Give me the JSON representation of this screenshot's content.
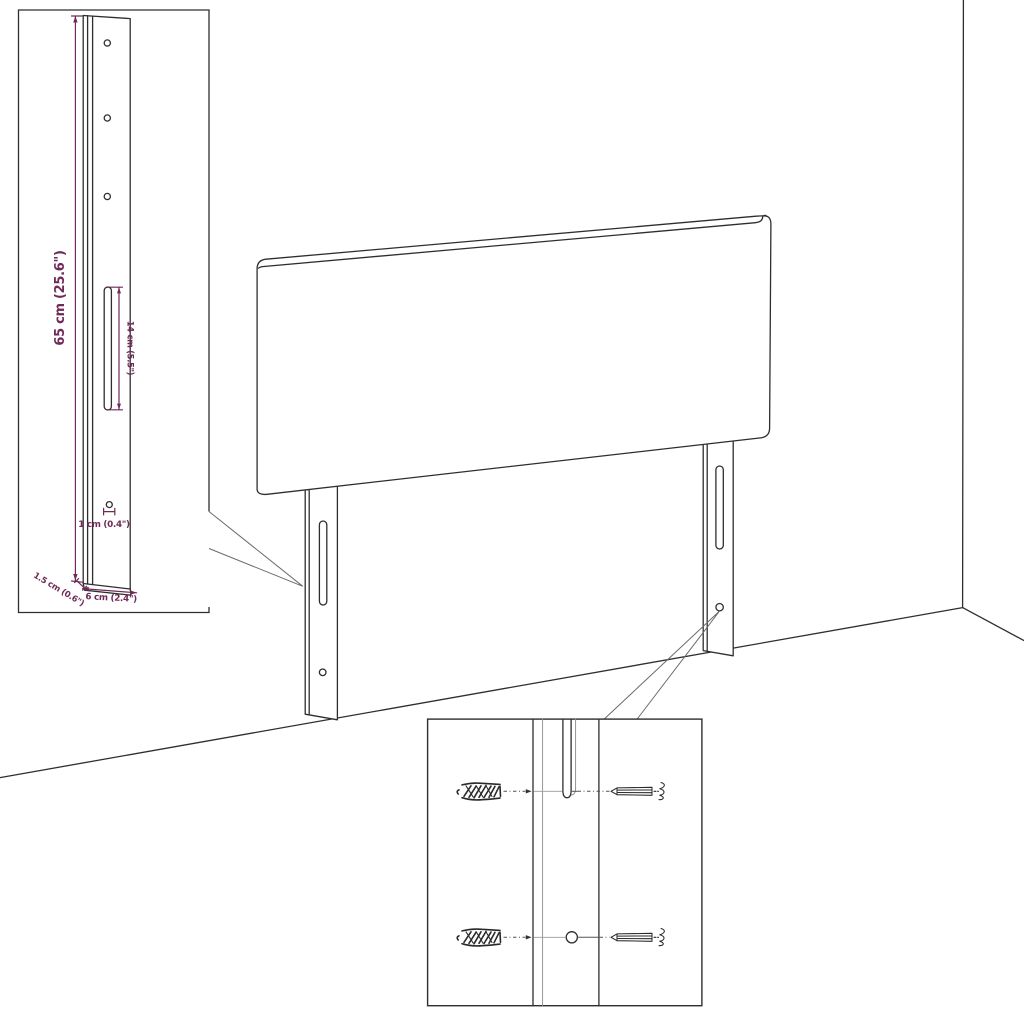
{
  "colors": {
    "dimension": "#6f2a58",
    "line": "#2e2e2e",
    "background": "#ffffff"
  },
  "leg_detail_inset": {
    "labels": {
      "leg_height": "65 cm (25.6\")",
      "slot_length": "14 cm (5.5\")",
      "hole_diameter": "1 cm (0.4\")",
      "leg_thickness": "1.5 cm (0.6\")",
      "leg_width": "6 cm (2.4\")"
    }
  },
  "hardware_detail_inset": {
    "icons": [
      "wall-plug-icon",
      "screw-icon"
    ]
  }
}
